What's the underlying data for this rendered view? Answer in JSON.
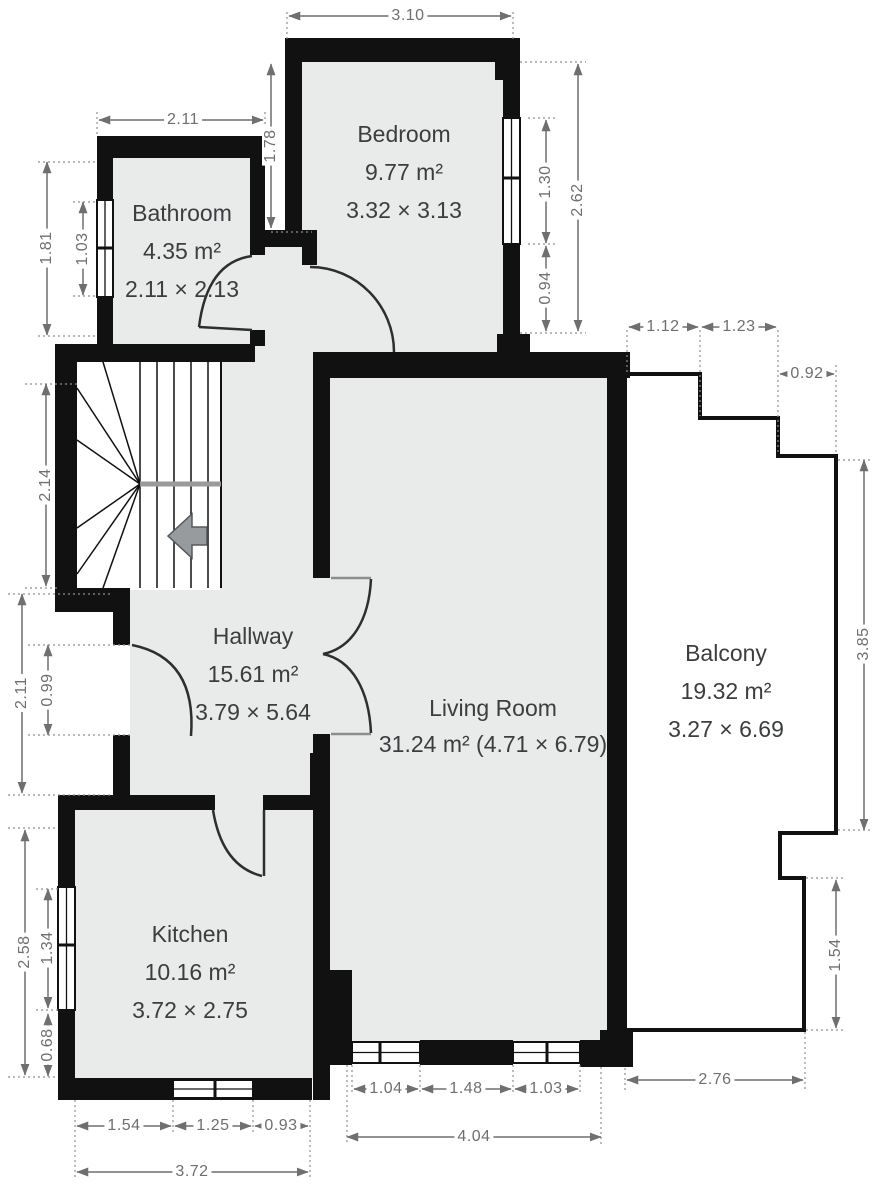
{
  "plan": {
    "title": "apartment-floor-plan",
    "colors": {
      "wall": "#111111",
      "room_fill": "#e9eaea",
      "dim_text": "#6f6f6f",
      "arrow_fill": "#989b9d"
    },
    "rooms": {
      "bathroom": {
        "name": "Bathroom",
        "area": "4.35 m²",
        "size": "2.11 × 2.13"
      },
      "bedroom": {
        "name": "Bedroom",
        "area": "9.77 m²",
        "size": "3.32 × 3.13"
      },
      "hallway": {
        "name": "Hallway",
        "area": "15.61 m²",
        "size": "3.79 × 5.64"
      },
      "living_room": {
        "name": "Living Room",
        "area": "31.24 m² (4.71 × 6.79)"
      },
      "balcony": {
        "name": "Balcony",
        "area": "19.32 m²",
        "size": "3.27 × 6.69"
      },
      "kitchen": {
        "name": "Kitchen",
        "area": "10.16 m²",
        "size": "3.72 × 2.75"
      }
    },
    "dimensions": {
      "bedroom_width_top": "3.10",
      "bathroom_width_top": "2.11",
      "bedroom_left_wall": "1.78",
      "bedroom_window_right": "1.30",
      "bedroom_right_total": "2.62",
      "bedroom_right_lower": "0.94",
      "bathroom_left_total": "1.81",
      "bathroom_window_left": "1.03",
      "stairs_height": "2.14",
      "hallway_left_total": "2.11",
      "entrance_door": "0.99",
      "kitchen_left_total": "2.58",
      "kitchen_window_left": "1.34",
      "kitchen_left_lower": "0.68",
      "balcony_step_1": "1.12",
      "balcony_step_2": "1.23",
      "balcony_step_3": "0.92",
      "balcony_right_upper": "3.85",
      "balcony_right_lower": "1.54",
      "balcony_bottom": "2.76",
      "living_window_left": "1.04",
      "living_wall_mid": "1.48",
      "living_window_right": "1.03",
      "living_bottom_total": "4.04",
      "kitchen_bottom_seg1": "1.54",
      "kitchen_window_bottom": "1.25",
      "kitchen_bottom_seg3": "0.93",
      "kitchen_bottom_total": "3.72"
    }
  }
}
